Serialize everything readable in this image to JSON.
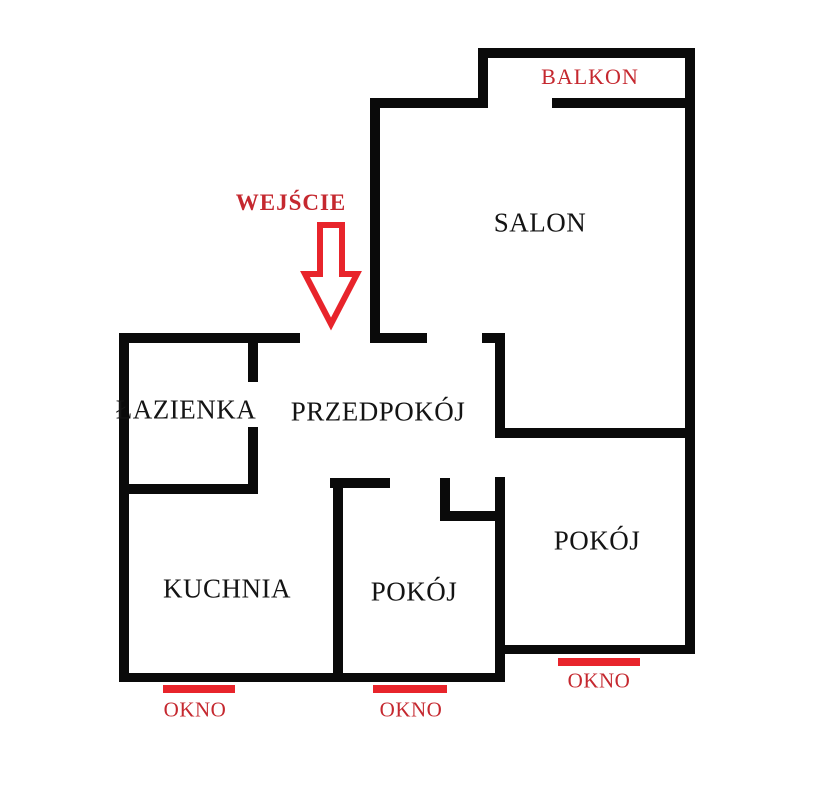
{
  "colors": {
    "background": "#ffffff",
    "wall": "#0a0a0a",
    "red_bright": "#e8242b",
    "red_text": "#c5282f",
    "room_text": "#141414"
  },
  "annotations": {
    "balkon": {
      "label": "BALKON",
      "cx": 590,
      "cy": 77
    },
    "wejscie": {
      "label": "WEJŚCIE",
      "cx": 291,
      "cy": 203
    }
  },
  "entrance_arrow": {
    "icon": "down-arrow",
    "points": "320,225 342,225 342,274 357,274 331,324 305,274 320,274",
    "stroke_width": 6,
    "fill": "#ffffff"
  },
  "rooms": [
    {
      "id": "salon",
      "label": "SALON",
      "cx": 540,
      "cy": 223
    },
    {
      "id": "lazienka",
      "label": "ŁAZIENKA",
      "cx": 186,
      "cy": 410
    },
    {
      "id": "przedpokoj",
      "label": "PRZEDPOKÓJ",
      "cx": 378,
      "cy": 412
    },
    {
      "id": "kuchnia",
      "label": "KUCHNIA",
      "cx": 227,
      "cy": 589
    },
    {
      "id": "pokoj-middle",
      "label": "POKÓJ",
      "cx": 414,
      "cy": 592
    },
    {
      "id": "pokoj-right",
      "label": "POKÓJ",
      "cx": 597,
      "cy": 541
    }
  ],
  "windows": [
    {
      "label": "OKNO",
      "bar": {
        "x": 163,
        "y": 685,
        "w": 72,
        "h": 8
      },
      "label_cx": 195,
      "label_cy": 710
    },
    {
      "label": "OKNO",
      "bar": {
        "x": 373,
        "y": 685,
        "w": 74,
        "h": 8
      },
      "label_cx": 411,
      "label_cy": 710
    },
    {
      "label": "OKNO",
      "bar": {
        "x": 558,
        "y": 658,
        "w": 82,
        "h": 8
      },
      "label_cx": 599,
      "label_cy": 681
    }
  ],
  "walls": [
    {
      "name": "balcony-top",
      "x": 478,
      "y": 48,
      "w": 217,
      "h": 10
    },
    {
      "name": "salon-top",
      "x": 370,
      "y": 98,
      "w": 118,
      "h": 10
    },
    {
      "name": "balcony-bottom-right",
      "x": 552,
      "y": 98,
      "w": 143,
      "h": 10
    },
    {
      "name": "entry-wall-left",
      "x": 119,
      "y": 333,
      "w": 181,
      "h": 10
    },
    {
      "name": "salon-bottom-left",
      "x": 370,
      "y": 333,
      "w": 57,
      "h": 10
    },
    {
      "name": "salon-bottom-right",
      "x": 482,
      "y": 333,
      "w": 23,
      "h": 10
    },
    {
      "name": "salon-pokoj-divider",
      "x": 495,
      "y": 428,
      "w": 200,
      "h": 10
    },
    {
      "name": "lazienka-bottom",
      "x": 119,
      "y": 484,
      "w": 139,
      "h": 10
    },
    {
      "name": "pokoj-middle-top",
      "x": 330,
      "y": 478,
      "w": 60,
      "h": 10
    },
    {
      "name": "hall-notch-bottom",
      "x": 440,
      "y": 511,
      "w": 65,
      "h": 10
    },
    {
      "name": "pokoj-right-bottom",
      "x": 495,
      "y": 645,
      "w": 200,
      "h": 9
    },
    {
      "name": "bottom-outer",
      "x": 119,
      "y": 673,
      "w": 386,
      "h": 9
    },
    {
      "name": "left-outer",
      "x": 119,
      "y": 333,
      "w": 10,
      "h": 349
    },
    {
      "name": "lazienka-right-upper",
      "x": 248,
      "y": 343,
      "w": 10,
      "h": 39
    },
    {
      "name": "lazienka-right-lower",
      "x": 248,
      "y": 427,
      "w": 10,
      "h": 67
    },
    {
      "name": "salon-left",
      "x": 370,
      "y": 98,
      "w": 10,
      "h": 245
    },
    {
      "name": "balcony-left",
      "x": 478,
      "y": 48,
      "w": 10,
      "h": 60
    },
    {
      "name": "kuchnia-pokoj-divider",
      "x": 333,
      "y": 478,
      "w": 10,
      "h": 204
    },
    {
      "name": "hall-notch-side",
      "x": 440,
      "y": 478,
      "w": 10,
      "h": 43
    },
    {
      "name": "hall-right-upper",
      "x": 495,
      "y": 333,
      "w": 10,
      "h": 104
    },
    {
      "name": "hall-right-lower",
      "x": 495,
      "y": 477,
      "w": 10,
      "h": 205
    },
    {
      "name": "right-outer",
      "x": 685,
      "y": 48,
      "w": 10,
      "h": 606
    }
  ]
}
